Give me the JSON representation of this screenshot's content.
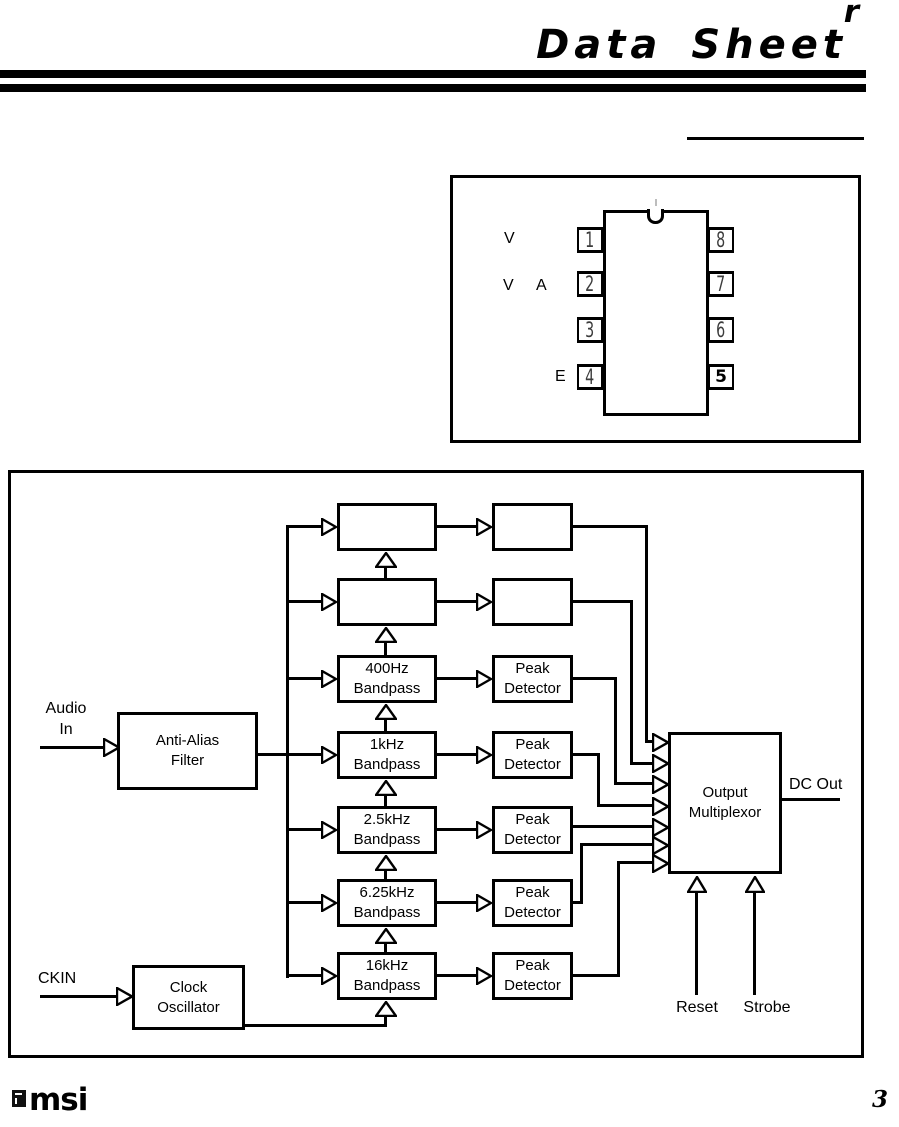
{
  "header": {
    "superscript": "r",
    "title": "Data Sheet"
  },
  "package": {
    "pins_left": [
      {
        "num": "1"
      },
      {
        "num": "2"
      },
      {
        "num": "3"
      },
      {
        "num": "4"
      }
    ],
    "pins_right": [
      {
        "num": "8"
      },
      {
        "num": "7"
      },
      {
        "num": "6"
      },
      {
        "num": "5"
      }
    ],
    "labels": {
      "pin1": "V",
      "pin2_a": "V",
      "pin2_b": "A",
      "pin4": "E"
    }
  },
  "diagram": {
    "audio_in": {
      "line1": "Audio",
      "line2": "In"
    },
    "ckin": "CKIN",
    "anti_alias": {
      "line1": "Anti-Alias",
      "line2": "Filter"
    },
    "clock_osc": {
      "line1": "Clock",
      "line2": "Oscillator"
    },
    "rows": [
      {
        "bp1": "",
        "bp2": "",
        "pd1": "",
        "pd2": ""
      },
      {
        "bp1": "",
        "bp2": "",
        "pd1": "",
        "pd2": ""
      },
      {
        "bp1": "400Hz",
        "bp2": "Bandpass",
        "pd1": "Peak",
        "pd2": "Detector"
      },
      {
        "bp1": "1kHz",
        "bp2": "Bandpass",
        "pd1": "Peak",
        "pd2": "Detector"
      },
      {
        "bp1": "2.5kHz",
        "bp2": "Bandpass",
        "pd1": "Peak",
        "pd2": "Detector"
      },
      {
        "bp1": "6.25kHz",
        "bp2": "Bandpass",
        "pd1": "Peak",
        "pd2": "Detector"
      },
      {
        "bp1": "16kHz",
        "bp2": "Bandpass",
        "pd1": "Peak",
        "pd2": "Detector"
      }
    ],
    "mux": {
      "line1": "Output",
      "line2": "Multiplexor"
    },
    "dc_out": "DC Out",
    "reset": "Reset",
    "strobe": "Strobe"
  },
  "footer": {
    "logo_text": "msi",
    "page_number": "3"
  },
  "colors": {
    "ink": "#000000",
    "paper": "#ffffff"
  }
}
